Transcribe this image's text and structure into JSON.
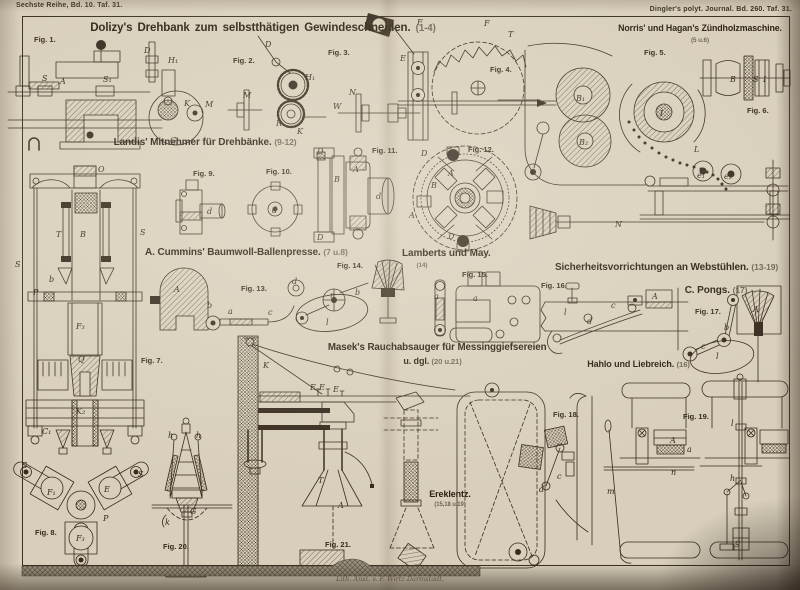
{
  "page": {
    "series_ref": "Sechste Reihe, Bd. 10. Taf. 31.",
    "journal_ref": "Dingler's polyt. Journal. Bd. 260. Taf. 31.",
    "credit": "Lith. Anst. v. F. Wirtz Darmstadt."
  },
  "sections": {
    "dolizy": {
      "title": "Dolizy's Drehbank zum selbstthätigen Gewindeschneiden.",
      "figs": "(1-4)"
    },
    "norris": {
      "title": "Norris' und Hagan's Zündholzmaschine.",
      "figs": "(5 u.6)"
    },
    "landis": {
      "title": "Landis' Mitnehmer für Drehbänke.",
      "figs": "(9-12)"
    },
    "cummins": {
      "title": "A. Cummins' Baumwoll-Ballenpresse.",
      "figs": "(7 u.8)"
    },
    "lamberts": {
      "title": "Lamberts und May.",
      "figs": "(14)"
    },
    "webstuehle": {
      "title": "Sicherheitsvorrichtungen an Webstühlen.",
      "figs": "(13-19)"
    },
    "pongs": {
      "title": "C. Pongs.",
      "figs": "(17)"
    },
    "hahlo": {
      "title": "Hahlo und Liebreich.",
      "figs": "(16)"
    },
    "masek": {
      "title": "Masek's Rauchabsauger für Messinggiefsereien",
      "title2": "u. dgl.",
      "figs": "(20 u.21)"
    },
    "ereklentz": {
      "title": "Ereklentz.",
      "figs": "(15,18 u.19)"
    }
  },
  "fig_labels": {
    "f1": "Fig. 1.",
    "f2": "Fig. 2.",
    "f3": "Fig. 3.",
    "f4": "Fig. 4.",
    "f5": "Fig. 5.",
    "f6": "Fig. 6.",
    "f7": "Fig. 7.",
    "f8": "Fig. 8.",
    "f9": "Fig. 9.",
    "f10": "Fig. 10.",
    "f11": "Fig. 11.",
    "f12": "Fig. 12.",
    "f13": "Fig. 13.",
    "f14": "Fig. 14.",
    "f15": "Fig. 15.",
    "f16": "Fig. 16.",
    "f17": "Fig. 17.",
    "f18": "Fig. 18.",
    "f19": "Fig. 19.",
    "f20": "Fig. 20.",
    "f21": "Fig. 21."
  },
  "parts": {
    "fig1": [
      "A",
      "S",
      "S₁",
      "D",
      "H₁",
      "K",
      "M",
      "G"
    ],
    "fig2": [
      "D",
      "M",
      "H₁",
      "K",
      "R"
    ],
    "fig3": [
      "N",
      "W",
      "F",
      "F",
      "T"
    ],
    "fig4": [
      "E"
    ],
    "fig5": [
      "B₁",
      "B₂",
      "I",
      "L",
      "N",
      "e₁",
      "e₂"
    ],
    "fig6": [
      "B",
      "S",
      "I"
    ],
    "fig7": [
      "O",
      "T",
      "B",
      "S",
      "S",
      "b",
      "P",
      "F₃",
      "Q",
      "K₂",
      "C₁"
    ],
    "fig8": [
      "S",
      "S",
      "F₁",
      "E",
      "P",
      "F₃"
    ],
    "fig9": [
      "d"
    ],
    "fig10": [
      "d"
    ],
    "fig11": [
      "D",
      "B",
      "A",
      "d",
      "D"
    ],
    "fig12": [
      "D",
      "A",
      "B",
      "A",
      "D"
    ],
    "fig13": [
      "A",
      "b",
      "a",
      "c",
      "d"
    ],
    "fig14": [
      "n",
      "b",
      "l"
    ],
    "fig15": [
      "a",
      "a"
    ],
    "fig16": [
      "l",
      "d",
      "c",
      "A"
    ],
    "fig17": [
      "A",
      "b",
      "c",
      "l"
    ],
    "fig18": [
      "c",
      "d"
    ],
    "fig19": [
      "A",
      "a",
      "n",
      "l",
      "m",
      "g",
      "h"
    ],
    "fig20": [
      "h",
      "h",
      "G",
      "k"
    ],
    "fig21": [
      "K",
      "E",
      "E",
      "E",
      "T",
      "A"
    ]
  },
  "colors": {
    "paper": "#d8cebb",
    "ink": "#352a1d",
    "edge_shadow": "#3c332a"
  }
}
